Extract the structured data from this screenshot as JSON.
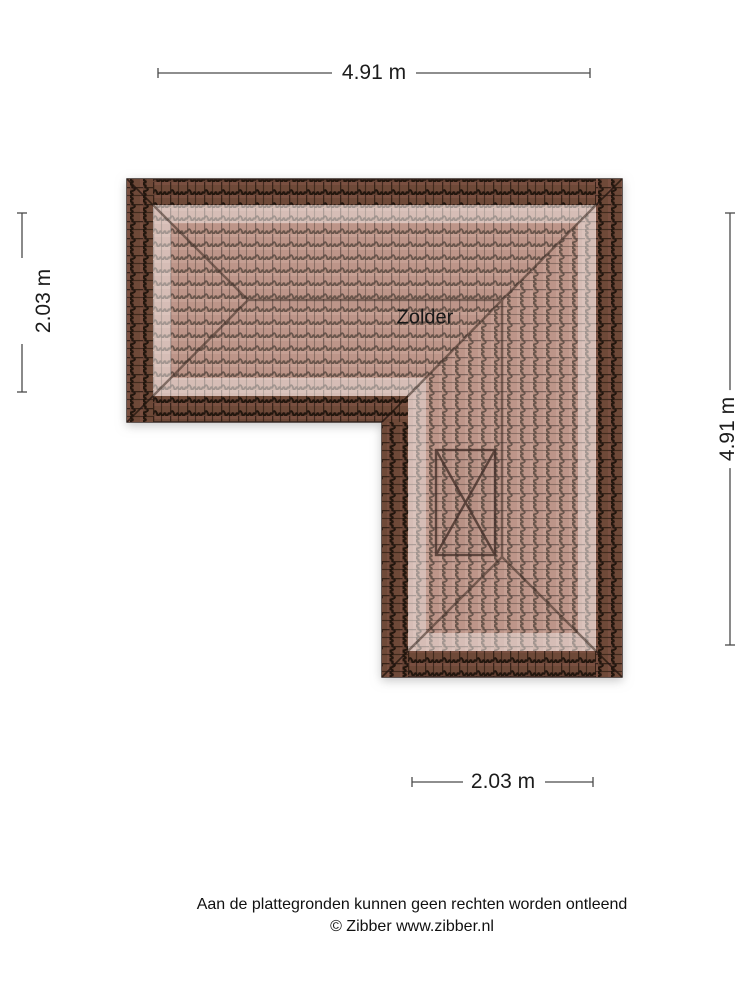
{
  "canvas": {
    "background": "#ffffff"
  },
  "floorplan": {
    "room_label": "Zolder",
    "icons": {
      "roof_window": "crossed-box-roof-window"
    },
    "colors": {
      "roof_edge_tile": "#6e4839",
      "roof_inner_tile": "#b68a7c",
      "tile_outline": "#241711",
      "hip_line": "#3a2a22",
      "dimension_line": "#4a4a4a",
      "text": "#1c1c1c"
    }
  },
  "dimensions": {
    "top": {
      "label": "4.91 m"
    },
    "left": {
      "label": "2.03 m"
    },
    "right": {
      "label": "4.91 m"
    },
    "bottom": {
      "label": "2.03 m"
    }
  },
  "footer": {
    "disclaimer": "Aan de plattegronden kunnen geen rechten worden ontleend",
    "copyright": "© Zibber www.zibber.nl"
  }
}
